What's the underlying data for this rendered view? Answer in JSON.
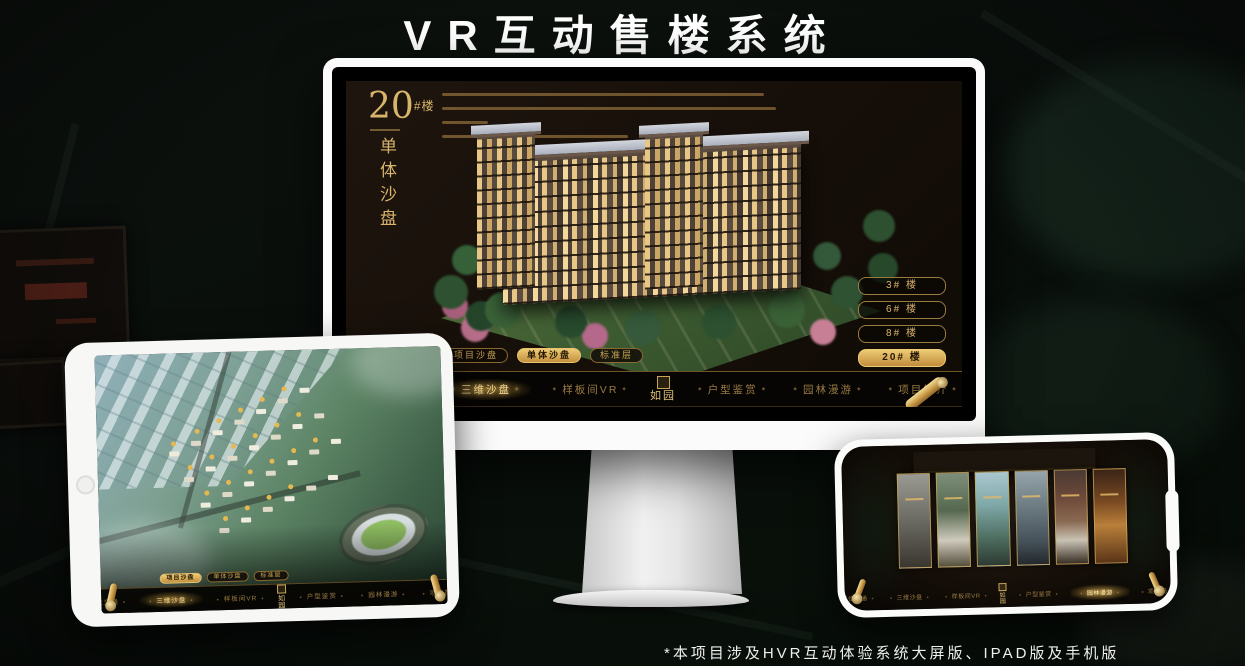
{
  "page": {
    "title": "VR互动售楼系统",
    "footnote": "*本项目涉及HVR互动体验系统大屏版、IPAD版及手机版"
  },
  "colors": {
    "gold": "#C9A455",
    "gold_bright": "#EFCF8C",
    "screen_bg": "#17100A",
    "nav_bg": "#070503",
    "background": "#0B100D"
  },
  "monitor": {
    "heading": {
      "number": "20",
      "suffix": "#楼",
      "vertical": "单体沙盘"
    },
    "floor_buttons": [
      {
        "label": "3# 楼",
        "active": false
      },
      {
        "label": "6# 楼",
        "active": false
      },
      {
        "label": "8# 楼",
        "active": false
      },
      {
        "label": "20# 楼",
        "active": true
      }
    ],
    "active_sub_tab": "单体沙盘",
    "active_nav_item": "三维沙盘"
  },
  "tablet": {
    "active_sub_tab": "项目沙盘"
  },
  "phone": {
    "active_nav_item": "园林漫游",
    "gallery_panel_count": 6
  },
  "shared": {
    "sub_tabs": [
      "项目沙盘",
      "单体沙盘",
      "标准层"
    ],
    "nav_items": [
      "区位交通",
      "三维沙盘",
      "样板间VR",
      "户型鉴赏",
      "园林漫游",
      "项目简介"
    ],
    "logo": "如园"
  }
}
